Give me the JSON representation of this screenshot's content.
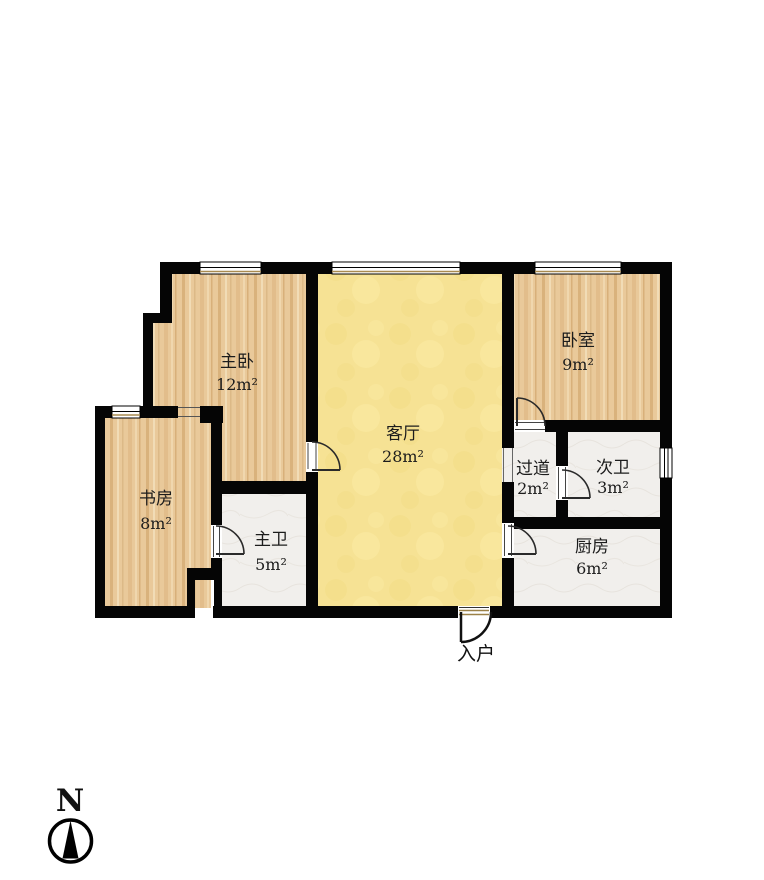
{
  "floorplan": {
    "rooms": [
      {
        "id": "master-bedroom",
        "name": "主卧",
        "area": "12m²",
        "floor": "wood"
      },
      {
        "id": "living-room",
        "name": "客厅",
        "area": "28m²",
        "floor": "yellow"
      },
      {
        "id": "bedroom",
        "name": "卧室",
        "area": "9m²",
        "floor": "wood"
      },
      {
        "id": "study",
        "name": "书房",
        "area": "8m²",
        "floor": "wood"
      },
      {
        "id": "master-bath",
        "name": "主卫",
        "area": "5m²",
        "floor": "tile"
      },
      {
        "id": "hallway",
        "name": "过道",
        "area": "2m²",
        "floor": "tile"
      },
      {
        "id": "second-bath",
        "name": "次卫",
        "area": "3m²",
        "floor": "tile"
      },
      {
        "id": "kitchen",
        "name": "厨房",
        "area": "6m²",
        "floor": "tile"
      }
    ],
    "entrance": {
      "label": "入户"
    },
    "compass": {
      "north_label": "N"
    },
    "colors": {
      "wall": "#050505",
      "wood_floor": "#e9c99a",
      "living_room_floor": "#f6e294",
      "tile_floor": "#f1efec",
      "sill_accent": "#a98b50"
    }
  }
}
